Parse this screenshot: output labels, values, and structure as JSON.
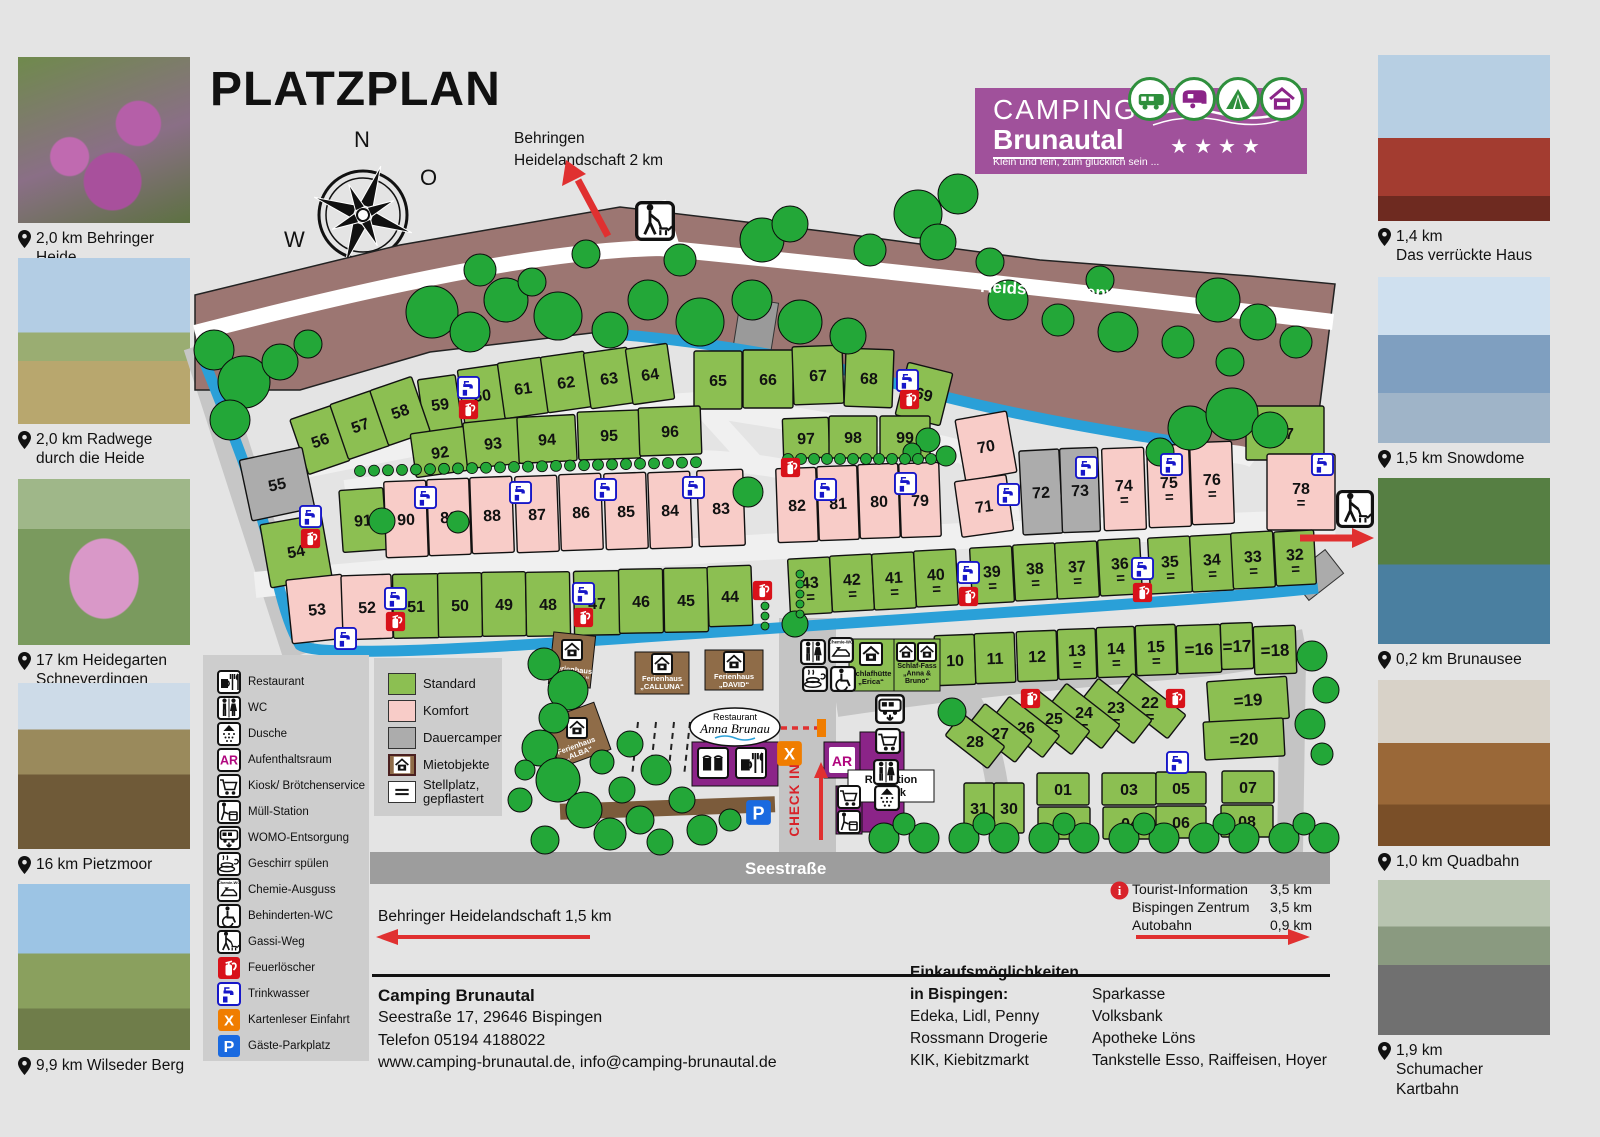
{
  "page": {
    "title": "PLATZPLAN"
  },
  "compass": {
    "north": "N",
    "east": "O",
    "south": "S",
    "west": "W"
  },
  "logo": {
    "line1": "CAMPING",
    "line2": "Brunautal",
    "tagline": "Klein und fein, zum glücklich sein ...",
    "stars": "★★★★",
    "badges": [
      "motorhome",
      "caravan",
      "tent",
      "house"
    ],
    "purple": "#a0519b"
  },
  "attractions_left": [
    {
      "caption": "2,0 km Behringer Heide"
    },
    {
      "caption": "2,0 km Radwege\ndurch die Heide"
    },
    {
      "caption": "17 km Heidegarten\nSchneverdingen"
    },
    {
      "caption": "16 km Pietzmoor"
    },
    {
      "caption": "9,9 km Wilseder Berg"
    }
  ],
  "attractions_right": [
    {
      "caption": "1,4 km\nDas verrückte Haus"
    },
    {
      "caption": "1,5 km Snowdome"
    },
    {
      "caption": "0,2 km Brunausee"
    },
    {
      "caption": "1,0 km Quadbahn"
    },
    {
      "caption": "1,9 km\nSchumacher Kartbahn"
    }
  ],
  "legend": {
    "facilities": [
      {
        "icon": "restaurant",
        "label": "Restaurant"
      },
      {
        "icon": "wc",
        "label": "WC"
      },
      {
        "icon": "dusche",
        "label": "Dusche"
      },
      {
        "icon": "aufenthaltsraum",
        "label": "Aufenthaltsraum"
      },
      {
        "icon": "kiosk",
        "label": "Kiosk/ Brötchenservice"
      },
      {
        "icon": "muell",
        "label": "Müll-Station"
      },
      {
        "icon": "womo",
        "label": "WOMO-Entsorgung"
      },
      {
        "icon": "geschirr",
        "label": "Geschirr spülen"
      },
      {
        "icon": "chemie",
        "label": "Chemie-Ausguss"
      },
      {
        "icon": "behinderten_wc",
        "label": "Behinderten-WC"
      },
      {
        "icon": "gassi",
        "label": "Gassi-Weg"
      },
      {
        "icon": "feuerloescher",
        "label": "Feuerlöscher"
      },
      {
        "icon": "trinkwasser",
        "label": "Trinkwasser"
      },
      {
        "icon": "kartenleser",
        "label": "Kartenleser Einfahrt"
      },
      {
        "icon": "parkplatz",
        "label": "Gäste-Parkplatz"
      }
    ],
    "pitch_types": [
      {
        "key": "standard",
        "label": "Standard",
        "color": "#8cbf52"
      },
      {
        "key": "komfort",
        "label": "Komfort",
        "color": "#f8ccc8"
      },
      {
        "key": "dauercamper",
        "label": "Dauercamper",
        "color": "#acacac"
      },
      {
        "key": "mietobjekte",
        "label": "Mietobjekte",
        "color": "#8f6c48"
      },
      {
        "key": "stellplatz",
        "label": "Stellplatz,\ngepflastert",
        "color": "#ffffff"
      }
    ]
  },
  "map": {
    "heidschnuckenweg": "Heidschnuckenweg",
    "seestrasse": "Seestraße",
    "check_in": "CHECK IN",
    "top_arrow": "Behringen\nHeidelandschaft 2 km",
    "bottom_left_arrow": "Behringer Heidelandschaft 1,5 km",
    "distances": [
      {
        "label": "Tourist-Information",
        "km": "3,5 km"
      },
      {
        "label": "Bispingen Zentrum",
        "km": "3,5 km"
      },
      {
        "label": "Autobahn",
        "km": "0,9 km"
      }
    ],
    "buildings": {
      "bonita": "Ferienhaus\n„BONITA“",
      "calluna": "Ferienhaus\n„CALLUNA“",
      "david": "Ferienhaus\n„DAVID“",
      "alba": "Ferienhaus\n„ALBA“",
      "restaurant_small": "Restaurant",
      "restaurant_name": "Anna Brunau",
      "schlafhuette": "Schlafhütte\n„Erica“",
      "schlaffass": "Schlaf-Fass\n„Anna &\nBruno“",
      "rezeption": "Rezeption\nKiosk",
      "ar": "AR",
      "x": "X",
      "p": "P",
      "info": "i"
    },
    "plots": [
      {
        "n": "59",
        "x": 440,
        "y": 404,
        "w": 38,
        "h": 54,
        "a": -8,
        "t": "s",
        "e": 0
      },
      {
        "n": "60",
        "x": 482,
        "y": 395,
        "w": 42,
        "h": 56,
        "a": -8,
        "t": "s",
        "e": 0
      },
      {
        "n": "61",
        "x": 523,
        "y": 388,
        "w": 44,
        "h": 56,
        "a": -8,
        "t": "s",
        "e": 0
      },
      {
        "n": "62",
        "x": 566,
        "y": 382,
        "w": 44,
        "h": 56,
        "a": -8,
        "t": "s",
        "e": 0
      },
      {
        "n": "63",
        "x": 609,
        "y": 378,
        "w": 44,
        "h": 56,
        "a": -8,
        "t": "s",
        "e": 0
      },
      {
        "n": "64",
        "x": 650,
        "y": 374,
        "w": 42,
        "h": 56,
        "a": -8,
        "t": "s",
        "e": 0
      },
      {
        "n": "65",
        "x": 718,
        "y": 380,
        "w": 48,
        "h": 58,
        "a": 0,
        "t": "s",
        "e": 0
      },
      {
        "n": "66",
        "x": 768,
        "y": 379,
        "w": 50,
        "h": 58,
        "a": 0,
        "t": "s",
        "e": 0
      },
      {
        "n": "67",
        "x": 818,
        "y": 375,
        "w": 50,
        "h": 58,
        "a": -2,
        "t": "s",
        "e": 0
      },
      {
        "n": "68",
        "x": 869,
        "y": 378,
        "w": 48,
        "h": 58,
        "a": 2,
        "t": "s",
        "e": 0
      },
      {
        "n": "69",
        "x": 924,
        "y": 394,
        "w": 46,
        "h": 54,
        "a": 14,
        "t": "s",
        "e": 0
      },
      {
        "n": "56",
        "x": 320,
        "y": 440,
        "w": 44,
        "h": 58,
        "a": -19,
        "t": "s",
        "e": 0
      },
      {
        "n": "57",
        "x": 360,
        "y": 425,
        "w": 44,
        "h": 58,
        "a": -19,
        "t": "s",
        "e": 0
      },
      {
        "n": "58",
        "x": 400,
        "y": 411,
        "w": 44,
        "h": 58,
        "a": -19,
        "t": "s",
        "e": 0
      },
      {
        "n": "92",
        "x": 440,
        "y": 452,
        "w": 54,
        "h": 44,
        "a": -8,
        "t": "s",
        "e": 0
      },
      {
        "n": "93",
        "x": 493,
        "y": 443,
        "w": 56,
        "h": 46,
        "a": -6,
        "t": "s",
        "e": 0
      },
      {
        "n": "94",
        "x": 547,
        "y": 439,
        "w": 58,
        "h": 46,
        "a": -3,
        "t": "s",
        "e": 0
      },
      {
        "n": "95",
        "x": 609,
        "y": 435,
        "w": 62,
        "h": 48,
        "a": -2,
        "t": "s",
        "e": 0
      },
      {
        "n": "96",
        "x": 670,
        "y": 431,
        "w": 62,
        "h": 48,
        "a": -2,
        "t": "s",
        "e": 0
      },
      {
        "n": "97",
        "x": 806,
        "y": 438,
        "w": 46,
        "h": 40,
        "a": -2,
        "t": "s",
        "e": 0
      },
      {
        "n": "98",
        "x": 853,
        "y": 437,
        "w": 48,
        "h": 42,
        "a": 0,
        "t": "s",
        "e": 0
      },
      {
        "n": "99",
        "x": 905,
        "y": 437,
        "w": 50,
        "h": 42,
        "a": 0,
        "t": "s",
        "e": 0
      },
      {
        "n": "70",
        "x": 986,
        "y": 446,
        "w": 52,
        "h": 62,
        "a": -10,
        "t": "k",
        "e": 0
      },
      {
        "n": "71",
        "x": 984,
        "y": 506,
        "w": 52,
        "h": 56,
        "a": -8,
        "t": "k",
        "e": 0
      },
      {
        "n": "72",
        "x": 1041,
        "y": 492,
        "w": 40,
        "h": 84,
        "a": -3,
        "t": "d",
        "e": 0
      },
      {
        "n": "73",
        "x": 1080,
        "y": 490,
        "w": 38,
        "h": 84,
        "a": -2,
        "t": "d",
        "e": 0
      },
      {
        "n": "74",
        "x": 1124,
        "y": 489,
        "w": 42,
        "h": 82,
        "a": -2,
        "t": "k",
        "e": 1
      },
      {
        "n": "75",
        "x": 1169,
        "y": 486,
        "w": 42,
        "h": 82,
        "a": -2,
        "t": "k",
        "e": 1
      },
      {
        "n": "76",
        "x": 1212,
        "y": 483,
        "w": 42,
        "h": 82,
        "a": -2,
        "t": "k",
        "e": 1
      },
      {
        "n": "77",
        "x": 1285,
        "y": 433,
        "w": 78,
        "h": 54,
        "a": 0,
        "t": "s",
        "e": 0
      },
      {
        "n": "78",
        "x": 1301,
        "y": 492,
        "w": 68,
        "h": 76,
        "a": 0,
        "t": "k",
        "e": 1
      },
      {
        "n": "91",
        "x": 363,
        "y": 520,
        "w": 44,
        "h": 62,
        "a": -4,
        "t": "s",
        "e": 0
      },
      {
        "n": "90",
        "x": 406,
        "y": 519,
        "w": 42,
        "h": 76,
        "a": -2,
        "t": "k",
        "e": 0
      },
      {
        "n": "89",
        "x": 449,
        "y": 517,
        "w": 42,
        "h": 76,
        "a": -2,
        "t": "k",
        "e": 0
      },
      {
        "n": "88",
        "x": 492,
        "y": 515,
        "w": 42,
        "h": 76,
        "a": -2,
        "t": "k",
        "e": 0
      },
      {
        "n": "87",
        "x": 537,
        "y": 514,
        "w": 42,
        "h": 76,
        "a": -2,
        "t": "k",
        "e": 0
      },
      {
        "n": "86",
        "x": 581,
        "y": 512,
        "w": 42,
        "h": 76,
        "a": -2,
        "t": "k",
        "e": 0
      },
      {
        "n": "85",
        "x": 626,
        "y": 511,
        "w": 42,
        "h": 76,
        "a": -2,
        "t": "k",
        "e": 0
      },
      {
        "n": "84",
        "x": 670,
        "y": 510,
        "w": 42,
        "h": 76,
        "a": -2,
        "t": "k",
        "e": 0
      },
      {
        "n": "83",
        "x": 721,
        "y": 508,
        "w": 46,
        "h": 76,
        "a": -2,
        "t": "k",
        "e": 0
      },
      {
        "n": "82",
        "x": 797,
        "y": 505,
        "w": 40,
        "h": 74,
        "a": -2,
        "t": "k",
        "e": 0
      },
      {
        "n": "81",
        "x": 838,
        "y": 503,
        "w": 40,
        "h": 74,
        "a": -2,
        "t": "k",
        "e": 0
      },
      {
        "n": "80",
        "x": 879,
        "y": 501,
        "w": 40,
        "h": 74,
        "a": -2,
        "t": "k",
        "e": 0
      },
      {
        "n": "79",
        "x": 920,
        "y": 500,
        "w": 40,
        "h": 74,
        "a": -2,
        "t": "k",
        "e": 0
      },
      {
        "n": "55",
        "x": 277,
        "y": 484,
        "w": 64,
        "h": 62,
        "a": -12,
        "t": "d",
        "e": 0
      },
      {
        "n": "54",
        "x": 296,
        "y": 551,
        "w": 62,
        "h": 64,
        "a": -10,
        "t": "s",
        "e": 0
      },
      {
        "n": "53",
        "x": 317,
        "y": 609,
        "w": 56,
        "h": 64,
        "a": -6,
        "t": "k",
        "e": 0
      },
      {
        "n": "52",
        "x": 367,
        "y": 607,
        "w": 50,
        "h": 64,
        "a": -2,
        "t": "k",
        "e": 0
      },
      {
        "n": "51",
        "x": 416,
        "y": 606,
        "w": 46,
        "h": 64,
        "a": -1,
        "t": "s",
        "e": 0
      },
      {
        "n": "50",
        "x": 460,
        "y": 605,
        "w": 44,
        "h": 64,
        "a": -1,
        "t": "s",
        "e": 0
      },
      {
        "n": "49",
        "x": 504,
        "y": 604,
        "w": 44,
        "h": 64,
        "a": -1,
        "t": "s",
        "e": 0
      },
      {
        "n": "48",
        "x": 548,
        "y": 604,
        "w": 44,
        "h": 64,
        "a": -1,
        "t": "s",
        "e": 0
      },
      {
        "n": "47",
        "x": 597,
        "y": 603,
        "w": 46,
        "h": 64,
        "a": -1,
        "t": "s",
        "e": 0
      },
      {
        "n": "46",
        "x": 641,
        "y": 601,
        "w": 44,
        "h": 64,
        "a": -1,
        "t": "s",
        "e": 0
      },
      {
        "n": "45",
        "x": 686,
        "y": 600,
        "w": 44,
        "h": 64,
        "a": -1,
        "t": "s",
        "e": 0
      },
      {
        "n": "44",
        "x": 730,
        "y": 596,
        "w": 44,
        "h": 60,
        "a": -2,
        "t": "s",
        "e": 0
      },
      {
        "n": "43",
        "x": 810,
        "y": 586,
        "w": 42,
        "h": 56,
        "a": -3,
        "t": "s",
        "e": 1
      },
      {
        "n": "42",
        "x": 852,
        "y": 583,
        "w": 42,
        "h": 56,
        "a": -3,
        "t": "s",
        "e": 1
      },
      {
        "n": "41",
        "x": 894,
        "y": 581,
        "w": 42,
        "h": 56,
        "a": -3,
        "t": "s",
        "e": 1
      },
      {
        "n": "40",
        "x": 936,
        "y": 578,
        "w": 42,
        "h": 56,
        "a": -3,
        "t": "s",
        "e": 1
      },
      {
        "n": "39",
        "x": 992,
        "y": 575,
        "w": 42,
        "h": 56,
        "a": -3,
        "t": "s",
        "e": 1
      },
      {
        "n": "38",
        "x": 1035,
        "y": 572,
        "w": 42,
        "h": 56,
        "a": -3,
        "t": "s",
        "e": 1
      },
      {
        "n": "37",
        "x": 1077,
        "y": 570,
        "w": 42,
        "h": 56,
        "a": -3,
        "t": "s",
        "e": 1
      },
      {
        "n": "36",
        "x": 1120,
        "y": 567,
        "w": 42,
        "h": 56,
        "a": -3,
        "t": "s",
        "e": 1
      },
      {
        "n": "35",
        "x": 1170,
        "y": 565,
        "w": 42,
        "h": 56,
        "a": -3,
        "t": "s",
        "e": 1
      },
      {
        "n": "34",
        "x": 1212,
        "y": 563,
        "w": 42,
        "h": 56,
        "a": -3,
        "t": "s",
        "e": 1
      },
      {
        "n": "33",
        "x": 1253,
        "y": 560,
        "w": 42,
        "h": 56,
        "a": -3,
        "t": "s",
        "e": 1
      },
      {
        "n": "32",
        "x": 1295,
        "y": 558,
        "w": 40,
        "h": 54,
        "a": -3,
        "t": "s",
        "e": 1
      },
      {
        "n": "10",
        "x": 955,
        "y": 660,
        "w": 40,
        "h": 50,
        "a": -2,
        "t": "s",
        "e": 0
      },
      {
        "n": "11",
        "x": 995,
        "y": 658,
        "w": 40,
        "h": 50,
        "a": -2,
        "t": "s",
        "e": 0
      },
      {
        "n": "12",
        "x": 1037,
        "y": 656,
        "w": 40,
        "h": 50,
        "a": -2,
        "t": "s",
        "e": 0
      },
      {
        "n": "13",
        "x": 1077,
        "y": 654,
        "w": 38,
        "h": 50,
        "a": -2,
        "t": "s",
        "e": 1
      },
      {
        "n": "14",
        "x": 1116,
        "y": 652,
        "w": 38,
        "h": 50,
        "a": -2,
        "t": "s",
        "e": 1
      },
      {
        "n": "15",
        "x": 1156,
        "y": 650,
        "w": 40,
        "h": 50,
        "a": -2,
        "t": "s",
        "e": 1
      },
      {
        "n": "16",
        "x": 1199,
        "y": 649,
        "w": 44,
        "h": 48,
        "a": -2,
        "t": "s",
        "e": 2
      },
      {
        "n": "17",
        "x": 1237,
        "y": 646,
        "w": 32,
        "h": 46,
        "a": -2,
        "t": "s",
        "e": 2
      },
      {
        "n": "18",
        "x": 1275,
        "y": 650,
        "w": 42,
        "h": 48,
        "a": -2,
        "t": "s",
        "e": 2
      },
      {
        "n": "19",
        "x": 1248,
        "y": 700,
        "w": 80,
        "h": 42,
        "a": -4,
        "t": "s",
        "e": 2
      },
      {
        "n": "20",
        "x": 1244,
        "y": 739,
        "w": 80,
        "h": 38,
        "a": -3,
        "t": "s",
        "e": 2
      },
      {
        "n": "22",
        "x": 1150,
        "y": 706,
        "w": 30,
        "h": 68,
        "a": -52,
        "t": "s",
        "e": 1
      },
      {
        "n": "23",
        "x": 1116,
        "y": 711,
        "w": 30,
        "h": 68,
        "a": -52,
        "t": "s",
        "e": 1
      },
      {
        "n": "24",
        "x": 1084,
        "y": 716,
        "w": 30,
        "h": 68,
        "a": -52,
        "t": "s",
        "e": 1
      },
      {
        "n": "25",
        "x": 1054,
        "y": 722,
        "w": 30,
        "h": 68,
        "a": -52,
        "t": "s",
        "e": 1
      },
      {
        "n": "26",
        "x": 1026,
        "y": 727,
        "w": 28,
        "h": 64,
        "a": -52,
        "t": "s",
        "e": 0
      },
      {
        "n": "27",
        "x": 1000,
        "y": 733,
        "w": 28,
        "h": 60,
        "a": -52,
        "t": "s",
        "e": 0
      },
      {
        "n": "28",
        "x": 975,
        "y": 741,
        "w": 28,
        "h": 54,
        "a": -52,
        "t": "s",
        "e": 0
      },
      {
        "n": "31",
        "x": 979,
        "y": 808,
        "w": 30,
        "h": 50,
        "a": 0,
        "t": "s",
        "e": 0
      },
      {
        "n": "30",
        "x": 1009,
        "y": 808,
        "w": 30,
        "h": 50,
        "a": 0,
        "t": "s",
        "e": 0
      },
      {
        "n": "01",
        "x": 1063,
        "y": 789,
        "w": 52,
        "h": 32,
        "a": 0,
        "t": "s",
        "e": 0
      },
      {
        "n": "02",
        "x": 1064,
        "y": 823,
        "w": 52,
        "h": 32,
        "a": 0,
        "t": "s",
        "e": 0
      },
      {
        "n": "03",
        "x": 1129,
        "y": 789,
        "w": 54,
        "h": 32,
        "a": 0,
        "t": "s",
        "e": 0
      },
      {
        "n": "04",
        "x": 1130,
        "y": 823,
        "w": 54,
        "h": 32,
        "a": 0,
        "t": "s",
        "e": 0
      },
      {
        "n": "05",
        "x": 1181,
        "y": 788,
        "w": 50,
        "h": 32,
        "a": 0,
        "t": "s",
        "e": 0
      },
      {
        "n": "06",
        "x": 1181,
        "y": 822,
        "w": 50,
        "h": 32,
        "a": 0,
        "t": "s",
        "e": 0
      },
      {
        "n": "07",
        "x": 1248,
        "y": 787,
        "w": 52,
        "h": 32,
        "a": 0,
        "t": "s",
        "e": 0
      },
      {
        "n": "08",
        "x": 1247,
        "y": 821,
        "w": 52,
        "h": 32,
        "a": 0,
        "t": "s",
        "e": 0
      }
    ]
  },
  "footer": {
    "name": "Camping Brunautal",
    "address": "Seestraße 17, 29646 Bispingen",
    "phone": "Telefon 05194 4188022",
    "web": "www.camping-brunautal.de, info@camping-brunautal.de"
  },
  "shopping": {
    "title1": "Einkaufsmöglichkeiten",
    "title2": "in Bispingen:",
    "col1": [
      "Edeka, Lidl, Penny",
      "Rossmann Drogerie",
      "KIK, Kiebitzmarkt"
    ],
    "col2": [
      "Sparkasse",
      "Volksbank",
      "Apotheke Löns",
      "Tankstelle Esso, Raiffeisen, Hoyer"
    ]
  },
  "colors": {
    "standard": "#8cbf52",
    "komfort": "#f8ccc8",
    "dauercamper": "#acacac",
    "stream": "#2aa0d8",
    "band": "#9c7672",
    "tree": "#23a738",
    "building_purple": "#8b2488",
    "house_brown": "#8f6c48"
  }
}
